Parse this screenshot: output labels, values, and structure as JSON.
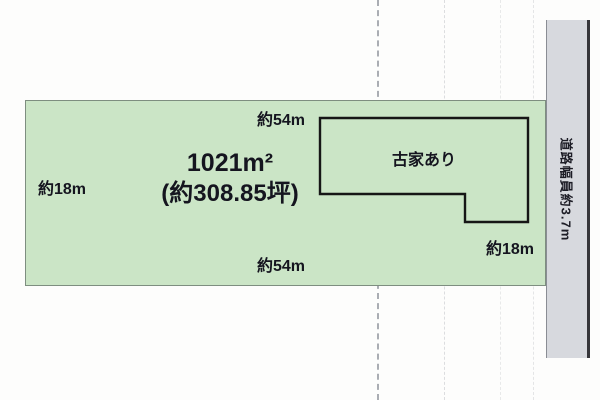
{
  "diagram": {
    "title": "land-plot-diagram",
    "plot": {
      "fill_color": "#cbe5c6",
      "area_label": "1021m²",
      "tsubo_label": "(約308.85坪)",
      "top_width_label": "約54m",
      "bottom_width_label": "約54m",
      "left_depth_label": "約18m",
      "right_depth_label": "約18m"
    },
    "house": {
      "label": "古家あり",
      "outline_color": "#161616"
    },
    "road": {
      "label": "道路幅員約3.7m",
      "fill_color": "#d7d9de"
    }
  }
}
